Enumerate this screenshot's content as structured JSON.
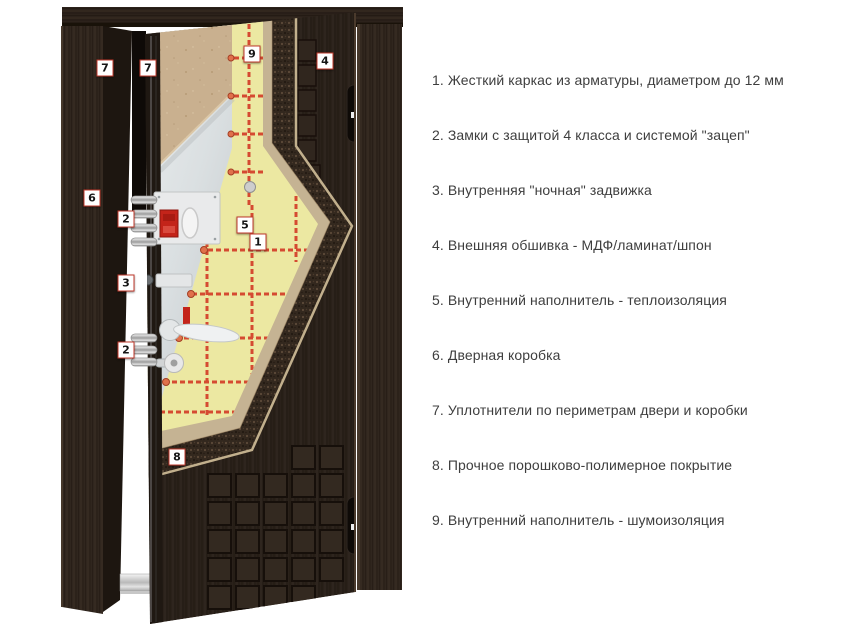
{
  "diagram": {
    "name": "steel-entrance-door-construction-cutaway",
    "callouts": [
      {
        "number": "7",
        "x": 105,
        "y": 68
      },
      {
        "number": "7",
        "x": 148,
        "y": 68
      },
      {
        "number": "9",
        "x": 252,
        "y": 54
      },
      {
        "number": "4",
        "x": 325,
        "y": 61
      },
      {
        "number": "6",
        "x": 92,
        "y": 198
      },
      {
        "number": "2",
        "x": 126,
        "y": 219
      },
      {
        "number": "5",
        "x": 245,
        "y": 225
      },
      {
        "number": "1",
        "x": 258,
        "y": 242
      },
      {
        "number": "3",
        "x": 126,
        "y": 283
      },
      {
        "number": "2",
        "x": 126,
        "y": 350
      },
      {
        "number": "8",
        "x": 177,
        "y": 457
      }
    ],
    "colors": {
      "callout_border": "#c0392b",
      "frame_wood": "#2e241c",
      "outer_panel": "#2b211a",
      "insulation_yellow": "#ece8a2",
      "rebar_red": "#d54a31",
      "mdf_tan": "#c9b08f",
      "metal_sheet": "#dfe2e4",
      "powder_coating": "#33281e",
      "edge_layer_tan": "#c5b393",
      "lock_red": "#c3241a",
      "threshold_silver": "#c9c9c9"
    }
  },
  "legend": {
    "items": [
      {
        "number": "1",
        "text": "Жесткий каркас из арматуры, диаметром до 12 мм"
      },
      {
        "number": "2",
        "text": "Замки с защитой 4 класса и системой \"зацеп\""
      },
      {
        "number": "3",
        "text": "Внутренняя \"ночная\" задвижка"
      },
      {
        "number": "4",
        "text": "Внешняя обшивка - МДФ/ламинат/шпон"
      },
      {
        "number": "5",
        "text": "Внутренний наполнитель - теплоизоляция"
      },
      {
        "number": "6",
        "text": "Дверная коробка"
      },
      {
        "number": "7",
        "text": "Уплотнители по периметрам двери и коробки"
      },
      {
        "number": "8",
        "text": "Прочное порошково-полимерное покрытие"
      },
      {
        "number": "9",
        "text": "Внутренний наполнитель - шумоизоляция"
      }
    ]
  }
}
